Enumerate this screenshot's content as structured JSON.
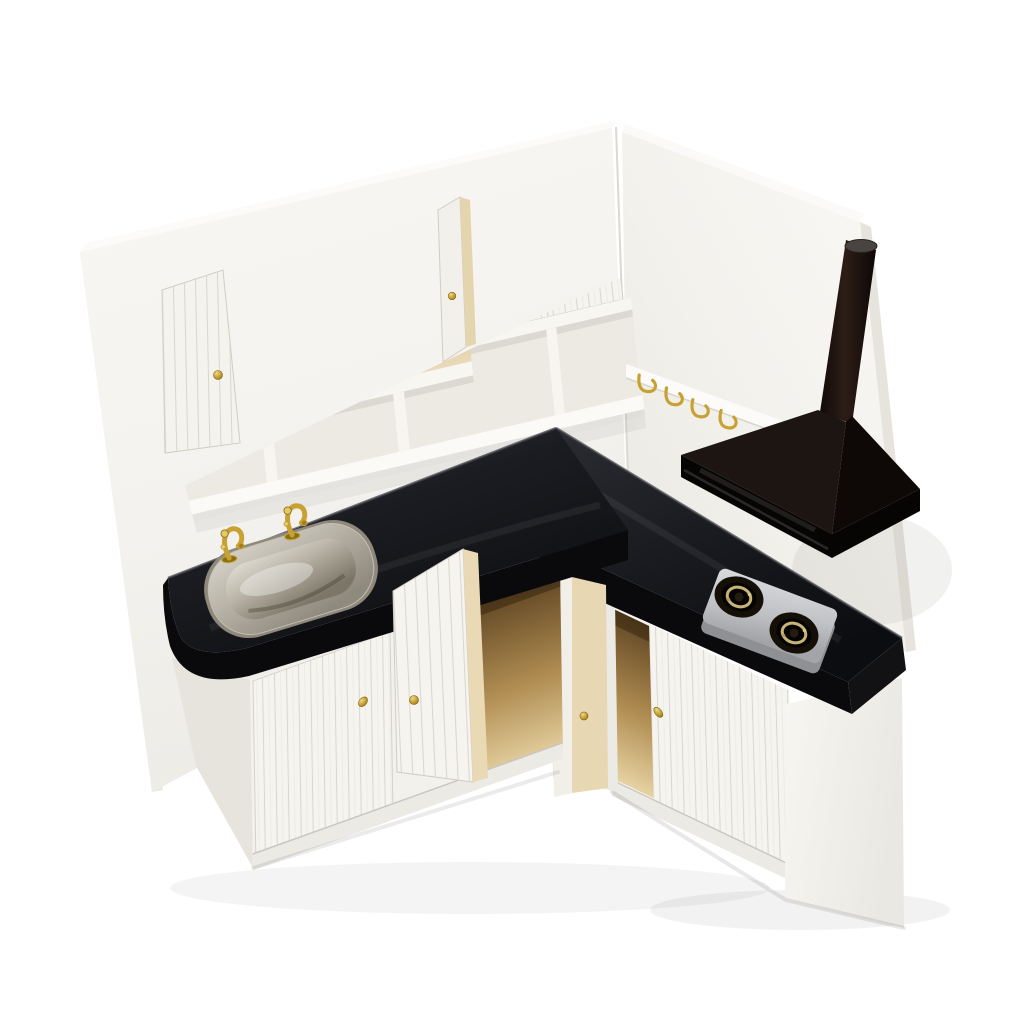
{
  "image": {
    "type": "product-photo",
    "subject": "Dollhouse miniature white wooden kitchen cabinet corner set",
    "background": "#ffffff"
  },
  "colors": {
    "wall_white": "#f7f5f2",
    "cabinet_white": "#f6f4ef",
    "shadow_white": "#eceae4",
    "counter_top": "#1b1c21",
    "counter_face": "#0a0a0c",
    "counter_end": "#121215",
    "hood_left": "#1c1512",
    "hood_right": "#0e0907",
    "hood_rim": "#070404",
    "chimney": "#1c120e",
    "stove_plate": "#c9cacd",
    "stove_plate_edge": "#8f9094",
    "burner_well": "#141008",
    "burner_brass": "#c9b478",
    "sink_silver": "#c3bfb4",
    "brass_gold": "#c7a233",
    "interior_wood_dark": "#5f4522",
    "interior_wood_light": "#ead9b8",
    "door_back_cream": "#e7d7b2",
    "plank_line": "#d9d6cf"
  },
  "scene": {
    "walls": {
      "left_panel": "white back panel",
      "right_panel": "white side panel"
    },
    "upper_cabinet": {
      "door_count": 6,
      "open_door_count": 2,
      "knob_count": 6,
      "shelf_compartments": 3
    },
    "countertop": {
      "shape": "L-shaped",
      "finish": "gloss black"
    },
    "sink": {
      "basin": "stainless steel",
      "faucet_count": 2
    },
    "hook_rail": {
      "hook_count": 4
    },
    "range_hood": {
      "style": "pyramid",
      "chimney": true
    },
    "stove": {
      "burner_count": 2
    },
    "base_cabinet_left": {
      "door_count": 2,
      "open_door_count": 1
    },
    "base_cabinet_right": {
      "door_count": 2,
      "open_door_count": 1
    }
  }
}
